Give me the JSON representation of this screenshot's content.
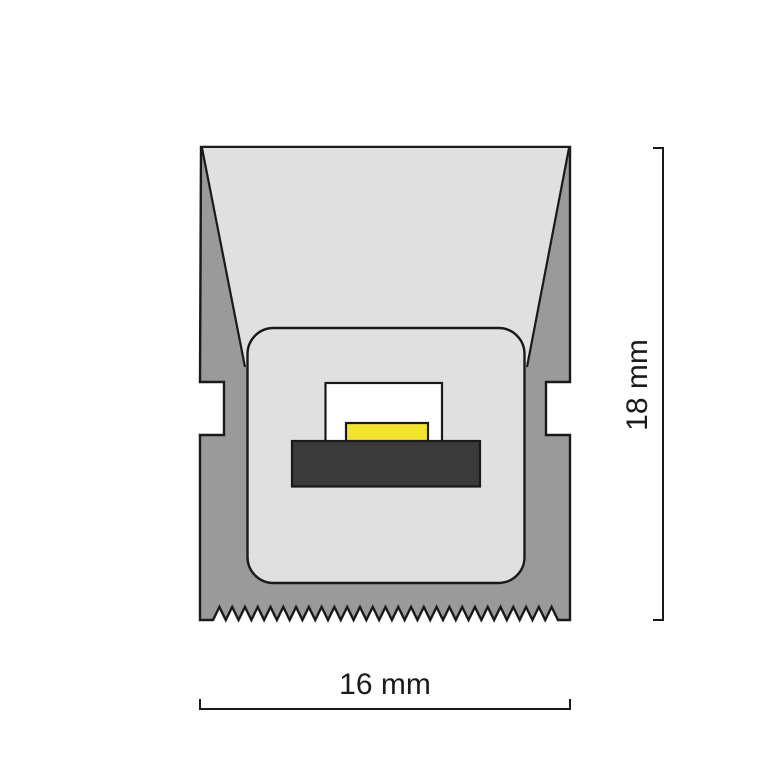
{
  "diagram": {
    "type": "led-profile-cross-section",
    "dimensions": {
      "height_label": "18 mm",
      "width_label": "16 mm"
    },
    "colors": {
      "background": "#ffffff",
      "body_gray": "#9a9a9a",
      "diffuser_gray": "#e0e0e0",
      "cavity_white": "#ffffff",
      "led_yellow": "#f2e32b",
      "pcb_dark": "#3a3a3a",
      "outline": "#1a1a1a"
    }
  }
}
